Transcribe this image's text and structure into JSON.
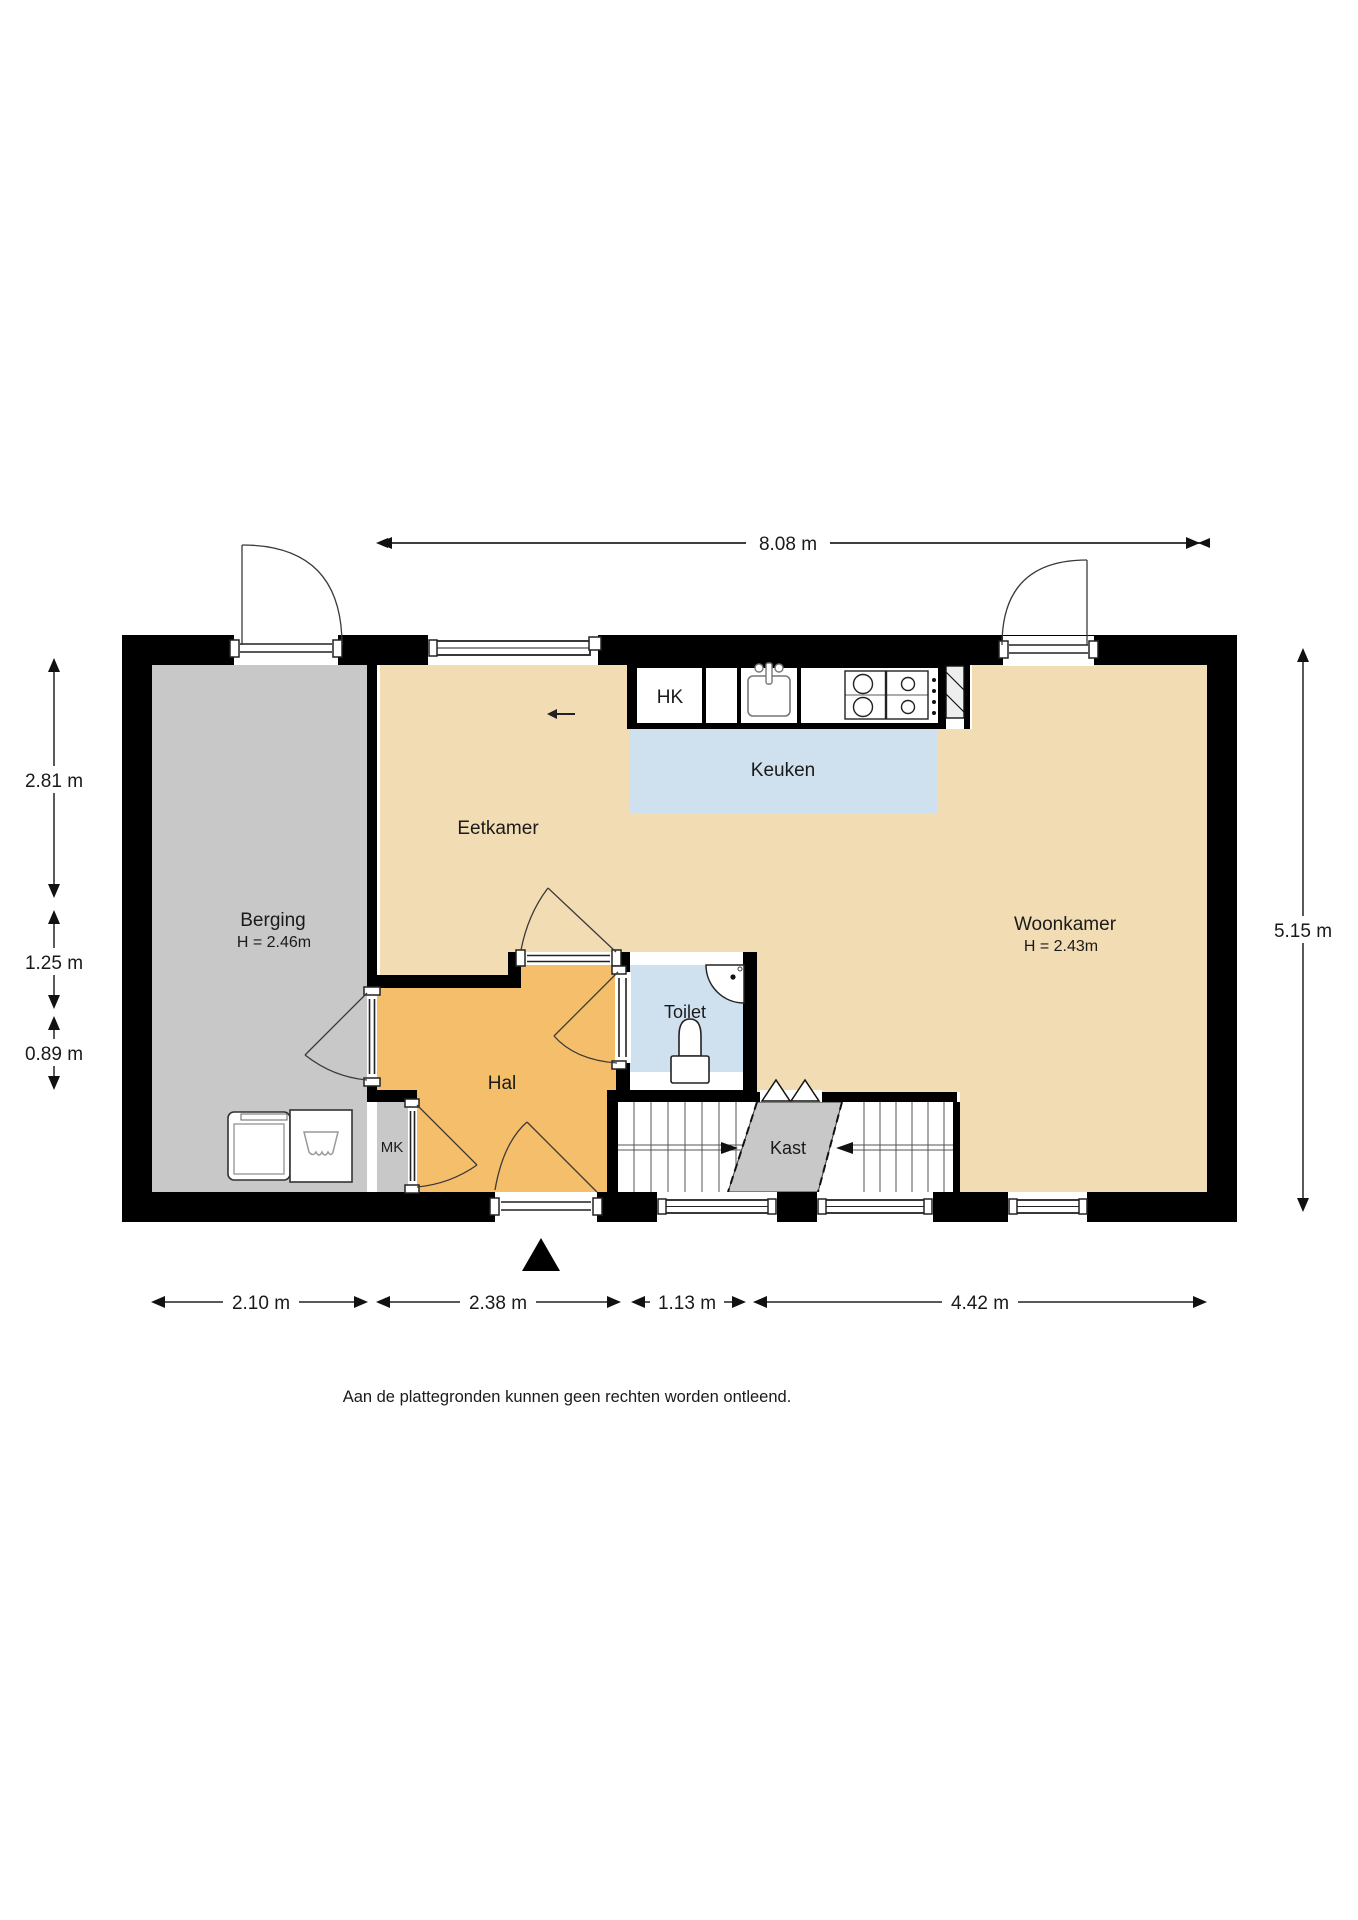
{
  "footer": "Aan de plattegronden kunnen geen rechten worden ontleend.",
  "rooms": {
    "berging": {
      "label": "Berging",
      "height": "H = 2.46m"
    },
    "eetkamer": {
      "label": "Eetkamer"
    },
    "keuken": {
      "label": "Keuken"
    },
    "woonkamer": {
      "label": "Woonkamer",
      "height": "H = 2.43m"
    },
    "hal": {
      "label": "Hal"
    },
    "toilet": {
      "label": "Toilet"
    },
    "mk": {
      "label": "MK"
    },
    "kast": {
      "label": "Kast"
    },
    "hk": {
      "label": "HK"
    }
  },
  "dimensions": {
    "top": "8.08 m",
    "left": [
      "2.81 m",
      "1.25 m",
      "0.89 m"
    ],
    "right": "5.15 m",
    "bottom": [
      "2.10 m",
      "2.38 m",
      "1.13 m",
      "4.42 m"
    ]
  },
  "colors": {
    "wall": "#000000",
    "floor": "#f2dcb4",
    "hal": "#f5be6b",
    "zone": "#cfe0ef",
    "storage": "#c8c8c8"
  }
}
